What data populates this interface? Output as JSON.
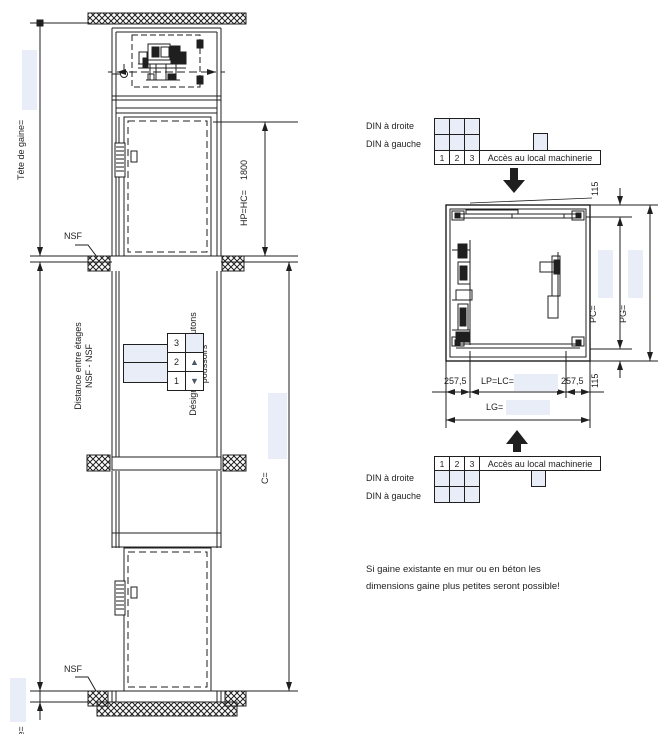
{
  "labels": {
    "tete_de_gaine": "Tête de gaine=",
    "nsf_top": "NSF",
    "nsf_bottom": "NSF",
    "hp_hc": "HP=HC=",
    "hp_hc_value": "1800",
    "c_dim": "C=",
    "fosse": "fosse=",
    "distance_line1": "Distance entre étages",
    "distance_line2": "NSF - NSF",
    "boutons_line1": "Désignations des boutons",
    "boutons_line2": "poussoirs"
  },
  "button_panel": {
    "floors": [
      "3",
      "2",
      "1"
    ],
    "up_icon": "▲",
    "down_icon": "▼"
  },
  "din_tables": {
    "top": {
      "din_droite": "DIN à droite",
      "din_gauche": "DIN à gauche",
      "floors": [
        "1",
        "2",
        "3"
      ],
      "access": "Accès au local machinerie"
    },
    "bottom": {
      "din_droite": "DIN à droite",
      "din_gauche": "DIN à gauche",
      "floors": [
        "1",
        "2",
        "3"
      ],
      "access": "Accès au local machinerie"
    }
  },
  "plan": {
    "dim_115_top": "115",
    "dim_115_bottom": "115",
    "pc": "PC=",
    "pg": "PG=",
    "dim_257_left": "257,5",
    "dim_257_right": "257,5",
    "lp_lc": "LP=LC=",
    "lg": "LG="
  },
  "note": {
    "line1": "Si gaine existante en mur ou en béton les",
    "line2": "dimensions gaine plus petites seront possible!"
  },
  "colors": {
    "field": "#e9edf8",
    "line": "#1f1f1f"
  }
}
